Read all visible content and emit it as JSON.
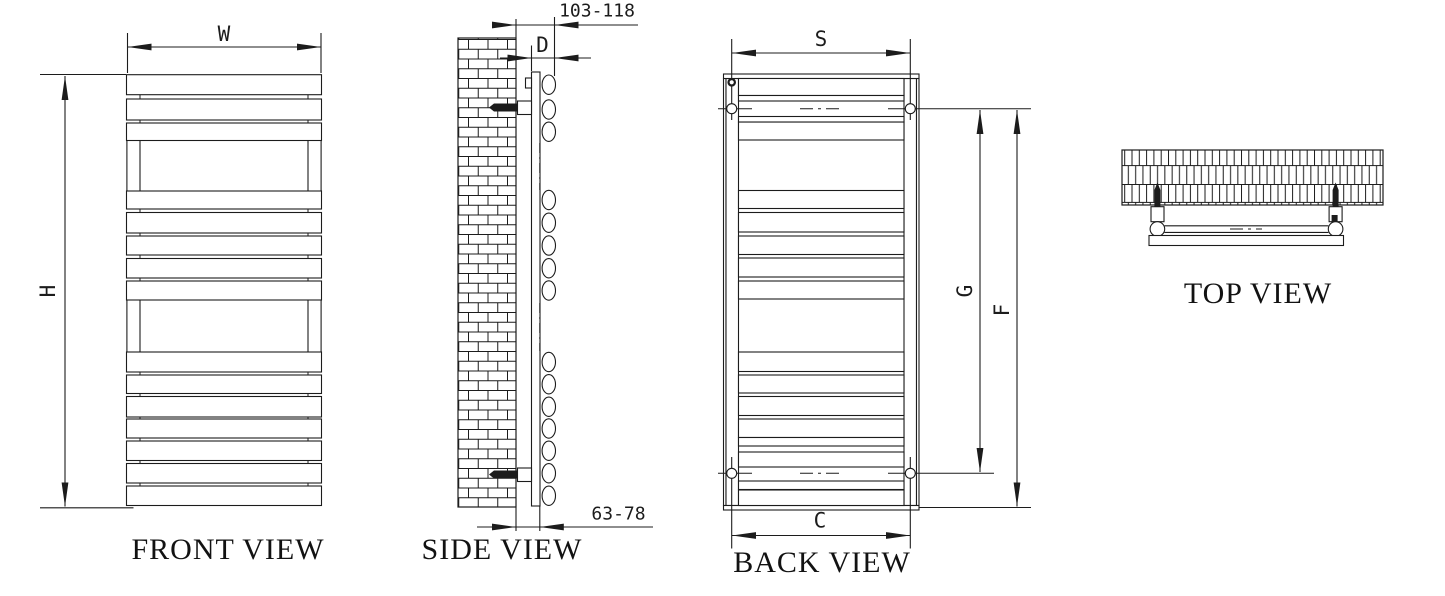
{
  "drawing_type": "towel-radiator technical drawing, 4 orthographic views",
  "colors": {
    "ink": "#1c1c1c",
    "paper": "#ffffff"
  },
  "views": {
    "front": {
      "title": "FRONT VIEW",
      "dims": {
        "width": "W",
        "height": "H"
      },
      "panels": [
        [
          74.7,
          20
        ],
        [
          99,
          21
        ],
        [
          123,
          17.5
        ],
        [
          191,
          18
        ],
        [
          212.5,
          20.5
        ],
        [
          236,
          19
        ],
        [
          258.5,
          19.5
        ],
        [
          281,
          19
        ],
        [
          352,
          20
        ],
        [
          375,
          18.5
        ],
        [
          396.5,
          20.5
        ],
        [
          419,
          19
        ],
        [
          441,
          19.5
        ],
        [
          463.5,
          19.5
        ],
        [
          486,
          19.5
        ]
      ],
      "openings": [
        [
          140.5,
          50.5
        ],
        [
          300,
          52
        ]
      ]
    },
    "side": {
      "title": "SIDE VIEW",
      "dims": {
        "depth": "D",
        "wall_to_front": "103-118",
        "wall_to_rail": "63-78"
      }
    },
    "back": {
      "title": "BACK VIEW",
      "dims": {
        "upper_mount_width": "S",
        "lower_mount_width": "C",
        "mount_span": "G",
        "mount_to_bottom": "F"
      },
      "bars": [
        [
          78.5,
          17
        ],
        [
          122,
          18
        ],
        [
          190.5,
          18
        ],
        [
          212.5,
          19.5
        ],
        [
          236,
          18.5
        ],
        [
          258,
          19
        ],
        [
          281,
          18
        ],
        [
          352,
          19.5
        ],
        [
          375,
          18
        ],
        [
          396.5,
          19
        ],
        [
          419,
          18.5
        ],
        [
          452,
          15
        ],
        [
          490,
          15.5
        ]
      ],
      "thin_bars": [
        [
          95.5,
          5.5
        ],
        [
          116.5,
          5.5
        ],
        [
          437.5,
          8.5
        ],
        [
          481,
          8.5
        ]
      ]
    },
    "top": {
      "title": "TOP VIEW"
    }
  }
}
